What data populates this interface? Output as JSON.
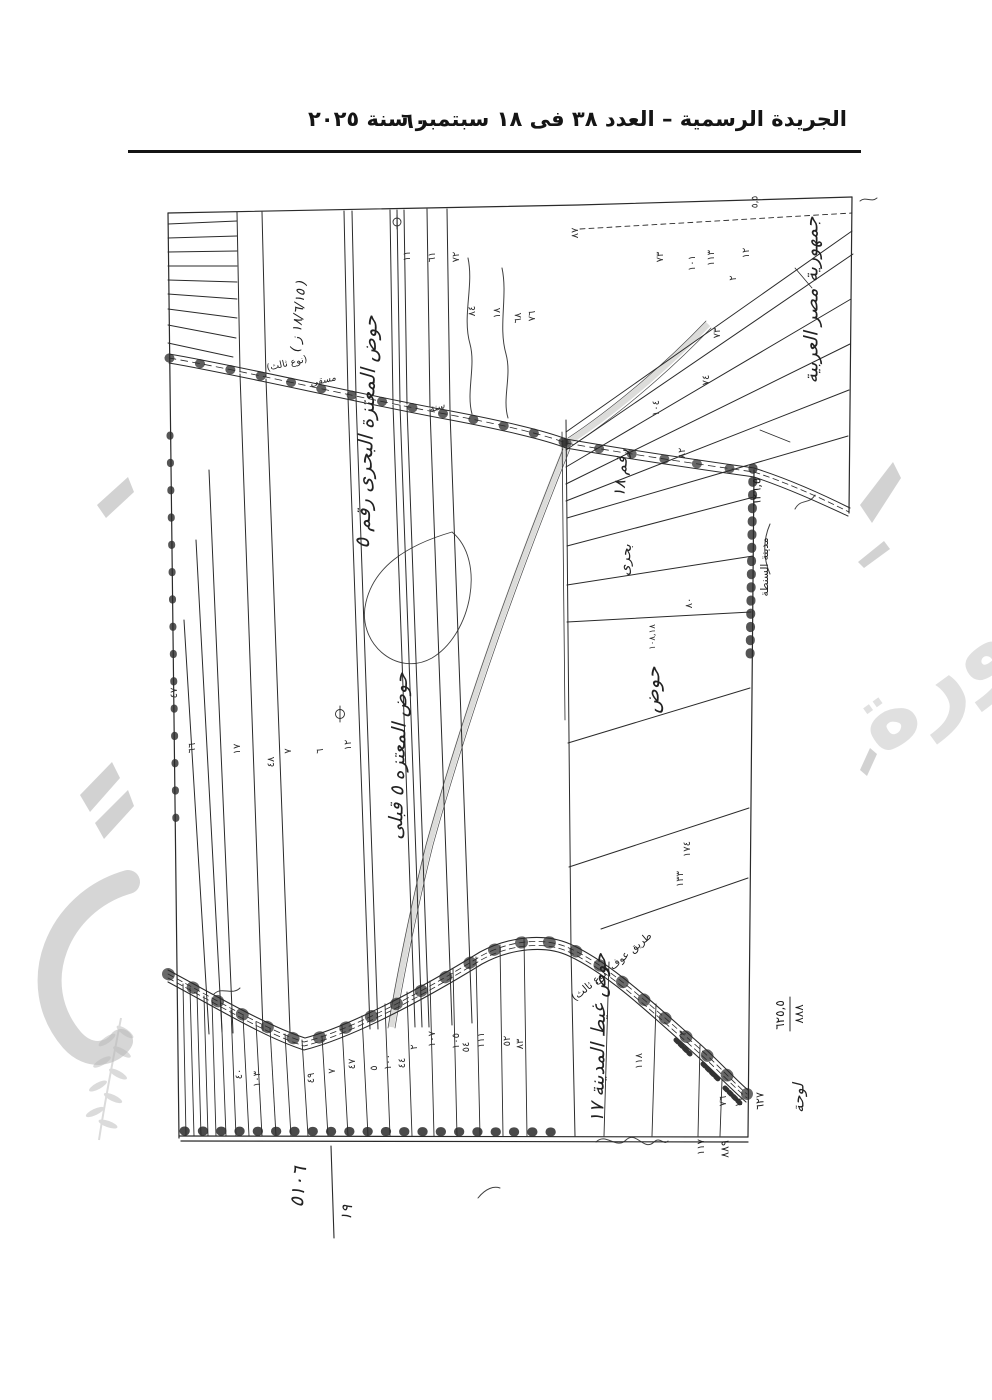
{
  "header": {
    "title": "الجريدة الرسمية – العدد ٣٨ فى ١٨ سبتمبر سنة ٢٠٢٥",
    "page_number": "٦٠"
  },
  "watermark": {
    "word": "صورة"
  },
  "map": {
    "labels": [
      {
        "t": "جمهورية مصر العربية",
        "x": 812,
        "y": 300,
        "r": -90,
        "s": 19,
        "hand": true
      },
      {
        "t": "حوض المعتزة البحرى رقم ٥",
        "x": 366,
        "y": 432,
        "r": -88,
        "s": 20,
        "hand": true
      },
      {
        "t": "( ١٨/٦/١٥ ز )",
        "x": 299,
        "y": 316,
        "r": -85,
        "s": 13,
        "hand": true
      },
      {
        "t": "حوض المعتزه ٥ قبلى",
        "x": 399,
        "y": 756,
        "r": -88,
        "s": 19,
        "hand": true
      },
      {
        "t": "رقم ١٨",
        "x": 621,
        "y": 473,
        "r": -86,
        "s": 16,
        "hand": true
      },
      {
        "t": "بحرى",
        "x": 626,
        "y": 560,
        "r": -86,
        "s": 14,
        "hand": true
      },
      {
        "t": "حوض",
        "x": 652,
        "y": 690,
        "r": -88,
        "s": 20,
        "hand": true
      },
      {
        "t": "حوض غيط المدينة ١٧",
        "x": 599,
        "y": 1038,
        "r": -89,
        "s": 19,
        "hand": true
      },
      {
        "t": "طريق عوف (نوع ثالث)",
        "x": 612,
        "y": 967,
        "r": -40,
        "s": 10.5
      },
      {
        "t": "(نوع ثالث)",
        "x": 287,
        "y": 364,
        "r": -13,
        "s": 9.5
      },
      {
        "t": "مسقى",
        "x": 323,
        "y": 381,
        "r": -13,
        "s": 9.5,
        "hand": true
      },
      {
        "t": "سنة",
        "x": 437,
        "y": 408,
        "r": -16,
        "s": 9.5,
        "hand": true
      },
      {
        "t": "مدينة السنطة",
        "x": 765,
        "y": 567,
        "r": -90,
        "s": 10.5
      },
      {
        "t": "٦٢٦,٥",
        "x": 757,
        "y": 492,
        "r": -90,
        "s": 11.5
      },
      {
        "t": "٨٨٨",
        "x": 799,
        "y": 1014,
        "r": -90,
        "s": 12
      },
      {
        "t": "٦٢٥,٥",
        "x": 780,
        "y": 1015,
        "r": -90,
        "s": 12
      },
      {
        "t": "لوحة",
        "x": 799,
        "y": 1098,
        "r": -90,
        "s": 15,
        "hand": true
      },
      {
        "t": "٦٢٧",
        "x": 760,
        "y": 1101,
        "r": -90,
        "s": 11
      },
      {
        "t": "٨٨٩",
        "x": 725,
        "y": 1149,
        "r": -90,
        "s": 11
      },
      {
        "t": "١١٧",
        "x": 702,
        "y": 1147,
        "r": -90,
        "s": 10
      },
      {
        "t": "٥١٠٦",
        "x": 299,
        "y": 1187,
        "r": -85,
        "s": 19,
        "hand": true
      },
      {
        "t": "١٩",
        "x": 347,
        "y": 1213,
        "r": -85,
        "s": 15,
        "hand": true
      },
      {
        "t": "٥,٥",
        "x": 756,
        "y": 202,
        "r": -90,
        "s": 9
      }
    ],
    "parcel_numbers": [
      {
        "t": "١١",
        "x": 408,
        "y": 256
      },
      {
        "t": "٦١",
        "x": 433,
        "y": 257
      },
      {
        "t": "٧٢",
        "x": 457,
        "y": 257
      },
      {
        "t": "٨٧",
        "x": 576,
        "y": 233
      },
      {
        "t": "٦٨",
        "x": 519,
        "y": 318
      },
      {
        "t": "٧٣",
        "x": 661,
        "y": 257
      },
      {
        "t": "١٠١",
        "x": 693,
        "y": 263
      },
      {
        "t": "١١٣",
        "x": 712,
        "y": 258
      },
      {
        "t": "١٢",
        "x": 747,
        "y": 253
      },
      {
        "t": "٢",
        "x": 734,
        "y": 278
      },
      {
        "t": "٧٣",
        "x": 718,
        "y": 333
      },
      {
        "t": "٧٤",
        "x": 707,
        "y": 380
      },
      {
        "t": "١٠٤",
        "x": 657,
        "y": 408
      },
      {
        "t": "٨٤",
        "x": 473,
        "y": 311
      },
      {
        "t": "١٨",
        "x": 498,
        "y": 313
      },
      {
        "t": "٧٦",
        "x": 533,
        "y": 316
      },
      {
        "t": "٨٢",
        "x": 683,
        "y": 453
      },
      {
        "t": "٨٠",
        "x": 690,
        "y": 603
      },
      {
        "t": "١٠٨,١٨",
        "x": 653,
        "y": 637,
        "s": 8.5
      },
      {
        "t": "١٧٤",
        "x": 688,
        "y": 849
      },
      {
        "t": "١٣٣",
        "x": 681,
        "y": 879
      },
      {
        "t": "٤٧",
        "x": 175,
        "y": 693
      },
      {
        "t": "٦٦",
        "x": 193,
        "y": 748
      },
      {
        "t": "١٧",
        "x": 238,
        "y": 749
      },
      {
        "t": "٤٨",
        "x": 272,
        "y": 762
      },
      {
        "t": "٧",
        "x": 289,
        "y": 751
      },
      {
        "t": "٦",
        "x": 321,
        "y": 751
      },
      {
        "t": "١٢",
        "x": 349,
        "y": 745
      },
      {
        "t": "٤٠",
        "x": 240,
        "y": 1074
      },
      {
        "t": "١٠٣",
        "x": 258,
        "y": 1079
      },
      {
        "t": "٤٩",
        "x": 312,
        "y": 1078
      },
      {
        "t": "٧",
        "x": 333,
        "y": 1071
      },
      {
        "t": "٤٧",
        "x": 353,
        "y": 1064
      },
      {
        "t": "٥",
        "x": 375,
        "y": 1068
      },
      {
        "t": "١٠٠",
        "x": 389,
        "y": 1062
      },
      {
        "t": "٤٤",
        "x": 403,
        "y": 1063
      },
      {
        "t": "٢",
        "x": 415,
        "y": 1047
      },
      {
        "t": "١٠٧",
        "x": 433,
        "y": 1039
      },
      {
        "t": "١٠٥",
        "x": 457,
        "y": 1041
      },
      {
        "t": "٥٤",
        "x": 467,
        "y": 1047
      },
      {
        "t": "١١١",
        "x": 482,
        "y": 1040
      },
      {
        "t": "٥٢",
        "x": 508,
        "y": 1041
      },
      {
        "t": "٨٣",
        "x": 521,
        "y": 1044
      },
      {
        "t": "١١٨",
        "x": 640,
        "y": 1061
      },
      {
        "t": "٣",
        "x": 684,
        "y": 1033
      },
      {
        "t": "٧٦",
        "x": 724,
        "y": 1101
      },
      {
        "t": "١١",
        "x": 740,
        "y": 1102
      }
    ]
  }
}
